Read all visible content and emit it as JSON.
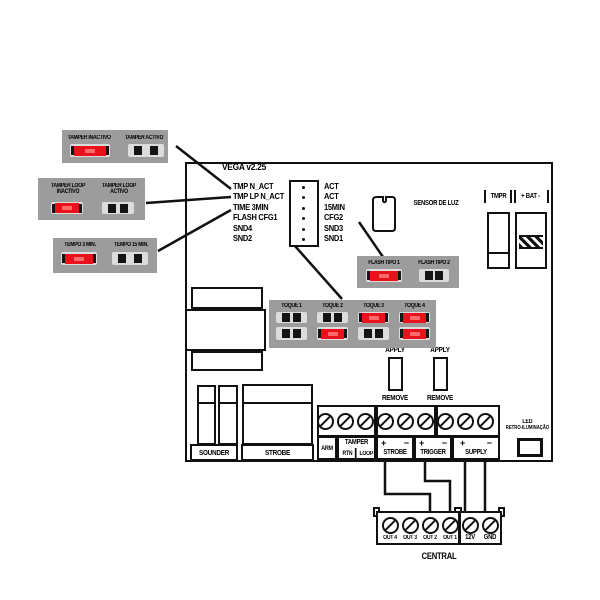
{
  "colors": {
    "red": "#e8111c",
    "box_gray": "#9c9c9c",
    "pad_gray": "#dcdcdc"
  },
  "board": {
    "title": "VEGA v2.25",
    "pins_left": [
      "TMP N_ACT",
      "TMP LP N_ACT",
      "TIME 3MIN",
      "FLASH CFG1",
      "SND4",
      "SND2"
    ],
    "pins_right": [
      "ACT",
      "ACT",
      "15MIN",
      "CFG2",
      "SND3",
      "SND1"
    ],
    "sensor_label": "SENSOR DE LUZ",
    "tmpr_label": "TMPR",
    "bat_label": "+ BAT -",
    "sounder_label": "SOUNDER",
    "strobe_label": "STROBE",
    "led_line1": "LED",
    "led_line2": "RETRO-ILUMINAÇÃO"
  },
  "callout_boxes": {
    "tamper": {
      "left_label": "TAMPER INACTIVO",
      "left_jumper": "closed",
      "right_label": "TAMPER ACTIVO",
      "right_jumper": "open"
    },
    "tamper_loop": {
      "left_label_1": "TAMPER LOOP",
      "left_label_2": "INACTIVO",
      "left_jumper": "closed",
      "right_label_1": "TAMPER LOOP",
      "right_label_2": "ACTIVO",
      "right_jumper": "open"
    },
    "tempo": {
      "left_label": "TEMPO 3 MIN.",
      "left_jumper": "closed",
      "right_label": "TEMPO 15 MIN.",
      "right_jumper": "open"
    },
    "flash": {
      "left_label": "FLASH TIPO 1",
      "left_jumper": "closed",
      "right_label": "FLASH TIPO 2",
      "right_jumper": "open"
    }
  },
  "toque": {
    "columns": [
      {
        "label": "TOQUE 1",
        "top": "open",
        "bottom": "open"
      },
      {
        "label": "TOQUE 2",
        "top": "open",
        "bottom": "closed"
      },
      {
        "label": "TOQUE 3",
        "top": "closed",
        "bottom": "open"
      },
      {
        "label": "TOQUE 4",
        "top": "closed",
        "bottom": "closed"
      }
    ]
  },
  "fuse": {
    "apply": "APPLY",
    "remove": "REMOVE"
  },
  "terminal_strip": {
    "arm": "ARM",
    "tamper_title": "TAMPER",
    "rtn": "RTN",
    "loop": "LOOP",
    "strobe": {
      "plus": "+",
      "minus": "−",
      "label": "STROBE"
    },
    "trigger": {
      "plus": "+",
      "minus": "−",
      "label": "TRIGGER"
    },
    "supply": {
      "plus": "+",
      "minus": "−",
      "label": "SUPPLY"
    }
  },
  "central": {
    "labels": [
      "OUT 4",
      "OUT 3",
      "OUT 2",
      "OUT 1",
      "12V",
      "GND"
    ],
    "title": "CENTRAL"
  }
}
